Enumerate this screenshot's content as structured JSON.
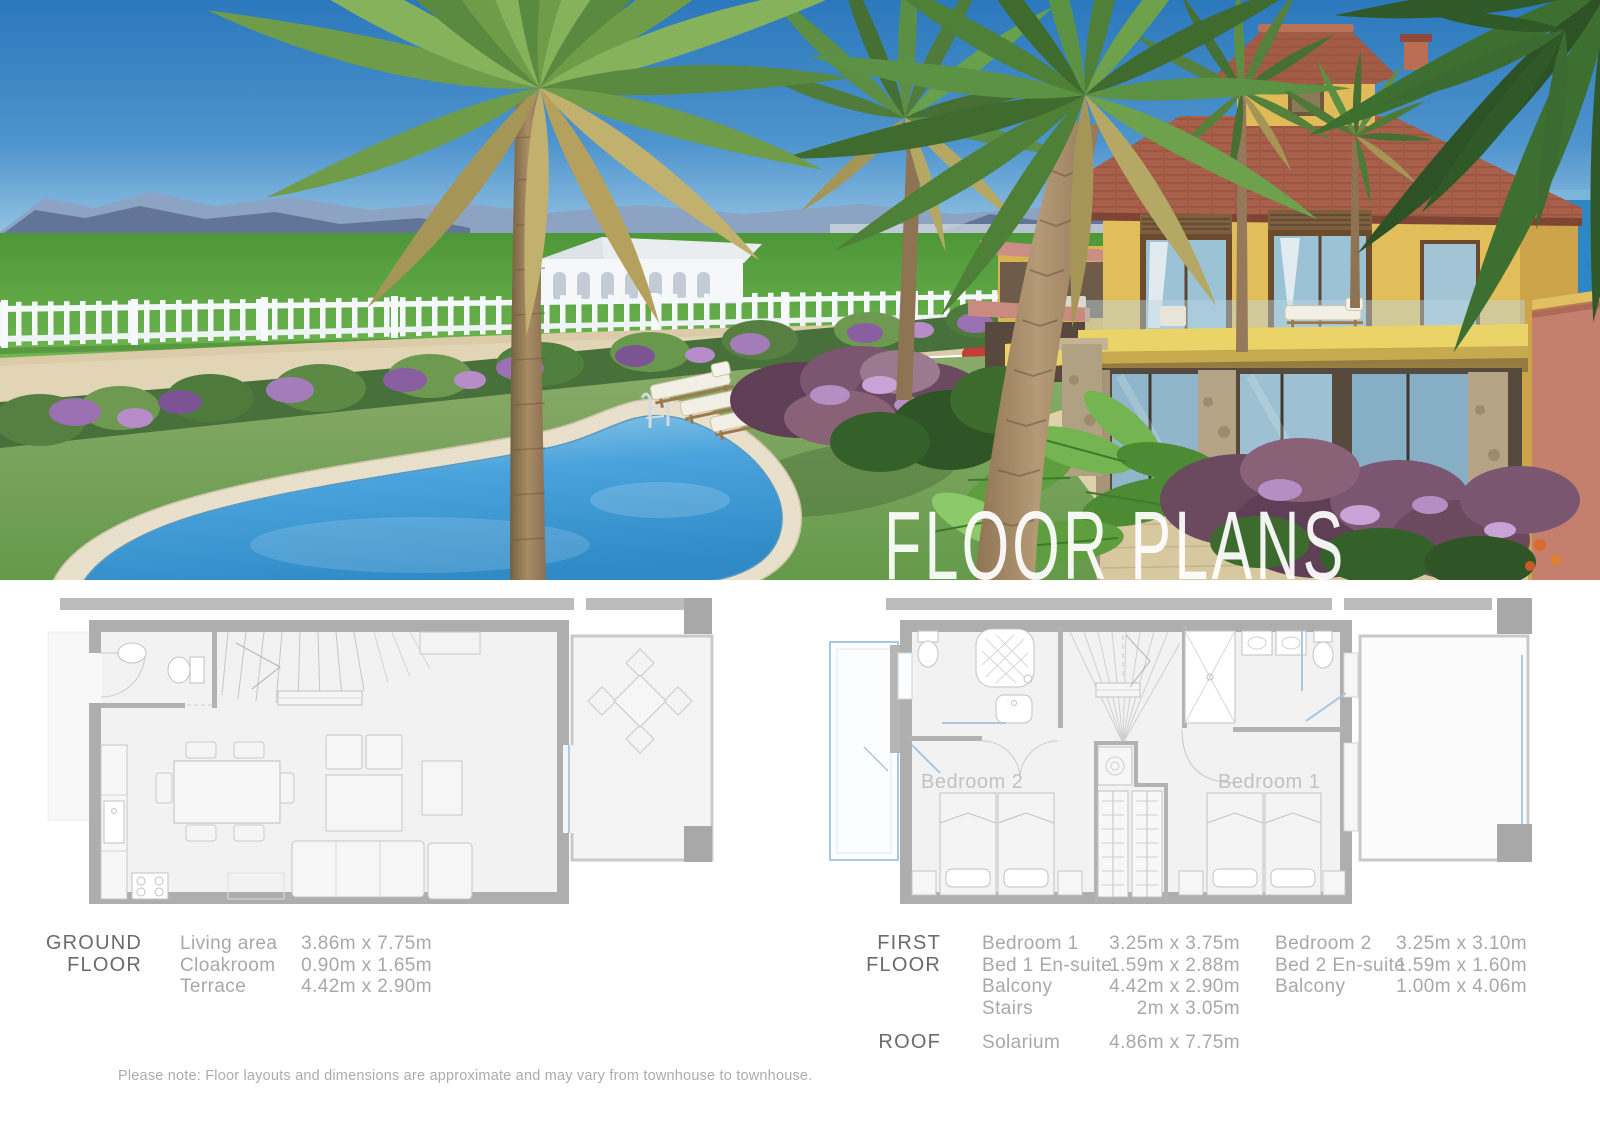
{
  "hero": {
    "overlay_title": "FLOOR PLANS"
  },
  "plan_labels": {
    "bedroom1": "Bedroom 1",
    "bedroom2": "Bedroom 2"
  },
  "tables": {
    "ground": {
      "floor_lines": [
        "GROUND",
        "FLOOR"
      ],
      "rows": [
        {
          "label": "Living area",
          "dims": "3.86m x 7.75m"
        },
        {
          "label": "Cloakroom",
          "dims": "0.90m x 1.65m"
        },
        {
          "label": "Terrace",
          "dims": "4.42m x 2.90m"
        }
      ]
    },
    "first": {
      "floor_lines": [
        "FIRST",
        "FLOOR"
      ],
      "col1": [
        {
          "label": "Bedroom 1",
          "dims": "3.25m x 3.75m"
        },
        {
          "label": "Bed 1 En-suite",
          "dims": "1.59m x 2.88m"
        },
        {
          "label": "Balcony",
          "dims": "4.42m x 2.90m"
        },
        {
          "label": "Stairs",
          "dims": "2m x 3.05m"
        }
      ],
      "col2": [
        {
          "label": "Bedroom 2",
          "dims": "3.25m x 3.10m"
        },
        {
          "label": "Bed 2 En-suite",
          "dims": "1.59m x 1.60m"
        },
        {
          "label": "Balcony",
          "dims": "1.00m x 4.06m"
        }
      ]
    },
    "roof": {
      "floor_label": "ROOF",
      "label": "Solarium",
      "dims": "4.86m x 7.75m"
    }
  },
  "note": "Please note: Floor layouts and dimensions are approximate and may vary from townhouse to townhouse.",
  "colors": {
    "heading_text": "#6a6b6d",
    "row_text": "#a6a8ab",
    "plan_wall": "#aeaeae",
    "plan_accent_blue": "#aac9e2",
    "villa_yellow": "#e2be5a",
    "roof_terracotta": "#a8604a",
    "pool_water": "#4aa3dc",
    "overlay_text": "#ffffff"
  }
}
